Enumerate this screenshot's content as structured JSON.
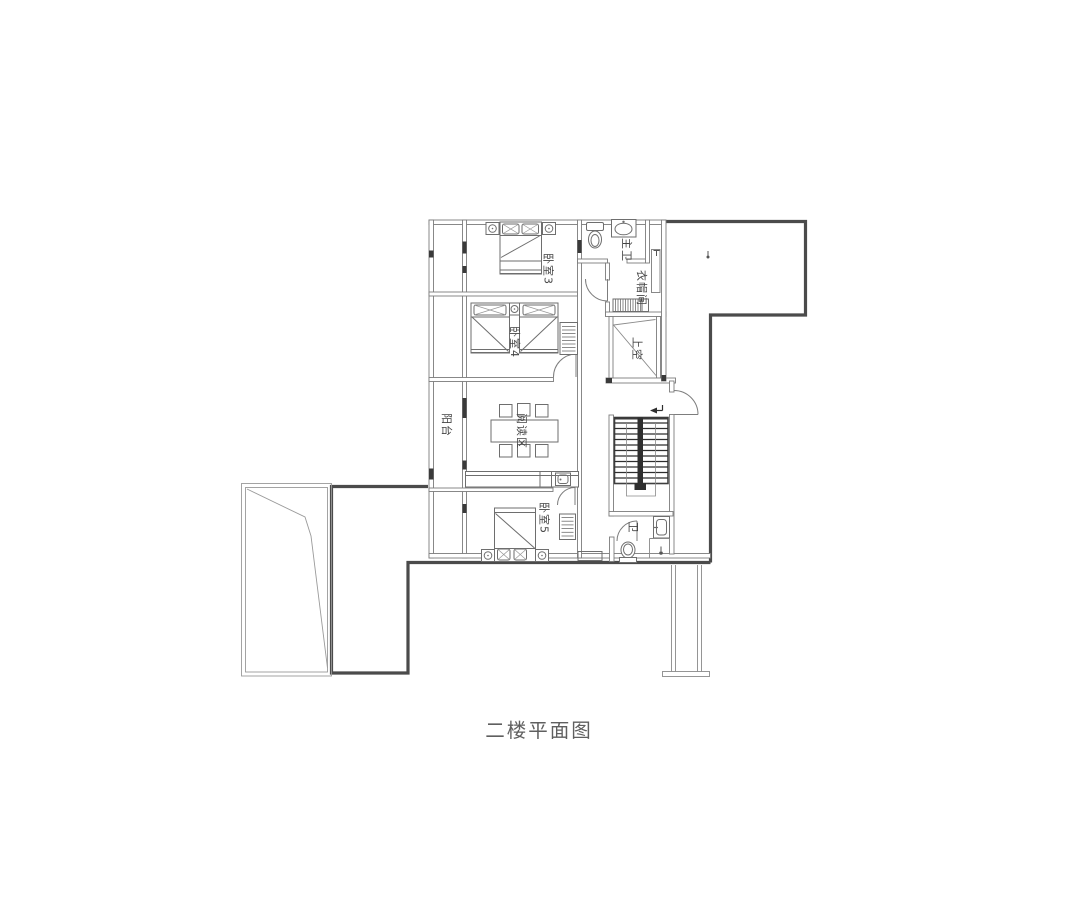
{
  "title": "二楼平面图",
  "rooms": {
    "bedroom3": {
      "label": "卧室3"
    },
    "bedroom4": {
      "label": "卧室4"
    },
    "bedroom5": {
      "label": "卧室5"
    },
    "master_bath": {
      "label": "主卫"
    },
    "cloakroom": {
      "label": "衣帽间"
    },
    "void": {
      "label": "上空"
    },
    "balcony": {
      "label": "阳台"
    },
    "reading": {
      "label": "阅读区"
    },
    "bath": {
      "label": "卫"
    }
  },
  "colors": {
    "wall": "#7c7c7c",
    "roof_outline": "#4b4b4b",
    "text": "#454545"
  }
}
